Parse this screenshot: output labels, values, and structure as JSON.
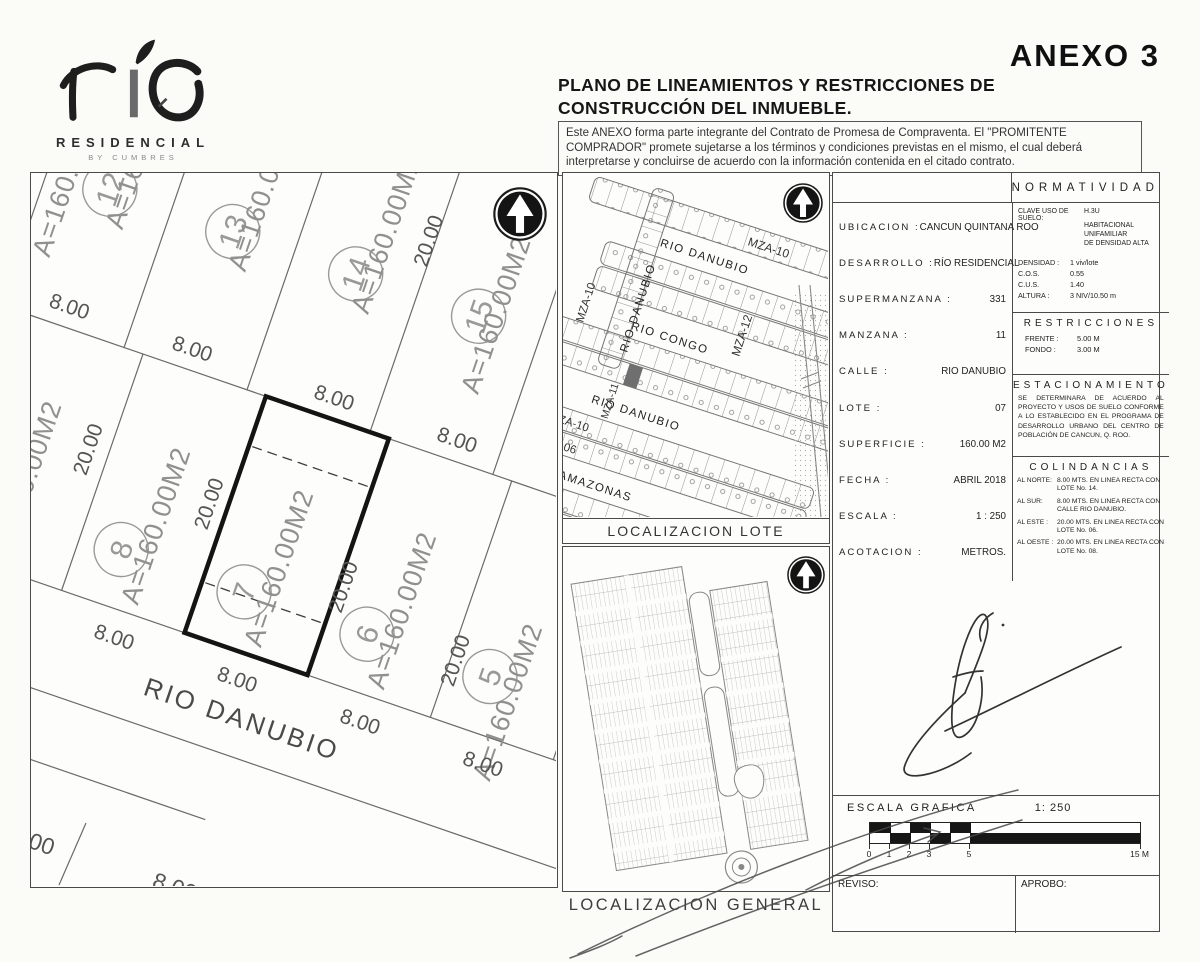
{
  "colors": {
    "ink": "#2f2f2f",
    "line": "#666666",
    "faded": "#909090",
    "highlight_lot_border": "#141414",
    "shaded_lot": "#6f6f6f",
    "paper": "#fbfbf8"
  },
  "logo": {
    "brand": "río",
    "line1": "RESIDENCIAL",
    "line2": "BY CUMBRES"
  },
  "header": {
    "annex": "ANEXO 3",
    "title_line1": "PLANO DE LINEAMIENTOS Y RESTRICCIONES DE",
    "title_line2": "CONSTRUCCIÓN DEL INMUEBLE.",
    "disclaimer": "Este ANEXO forma parte integrante del Contrato de Promesa de Compraventa. El \"PROMITENTE COMPRADOR\" promete sujetarse a los términos y condiciones previstas en el mismo, el cual deberá interpretarse y concluirse de acuerdo con la información contenida en el citado contrato."
  },
  "site_plan": {
    "street": "RIO DANUBIO",
    "area_label": "A=160.00M2",
    "front_dim": "8.00",
    "depth_dim": "20.00",
    "lots_top": [
      "12",
      "13",
      "14",
      "15"
    ],
    "lots_bottom": [
      "8",
      "7",
      "6",
      "5"
    ],
    "highlighted_lot": "7"
  },
  "map_lote": {
    "caption": "LOCALIZACION LOTE",
    "street_top": "RIO DANUBIO",
    "street_left": "RIO DANUBIO",
    "street_congo": "RIO CONGO",
    "street_lower": "RIO DANUBIO",
    "street_amazonas": "RIO AMAZONAS",
    "mza_top": "MZA-10",
    "mza_left": "MZA-10",
    "mza_12": "MZA-12",
    "mza_11": "MZA-11",
    "mza_10b": "MZA-10",
    "mza_06": "MZA-06"
  },
  "map_general": {
    "caption": "LOCALIZACION GENERAL"
  },
  "panel": {
    "normatividad_title": "NORMATIVIDAD",
    "fields": [
      {
        "label": "UBICACION :",
        "value": "CANCUN QUINTANA ROO"
      },
      {
        "label": "DESARROLLO :",
        "value": "RÍO RESIDENCIAL"
      },
      {
        "label": "SUPERMANZANA :",
        "value": "331"
      },
      {
        "label": "MANZANA :",
        "value": "11"
      },
      {
        "label": "CALLE :",
        "value": "RIO DANUBIO"
      },
      {
        "label": "LOTE :",
        "value": "07"
      },
      {
        "label": "SUPERFICIE :",
        "value": "160.00 M2"
      },
      {
        "label": "FECHA :",
        "value": "ABRIL 2018"
      },
      {
        "label": "ESCALA :",
        "value": "1 : 250"
      },
      {
        "label": "ACOTACION :",
        "value": "METROS."
      }
    ],
    "clave_label": "CLAVE USO DE SUELO:",
    "clave_value": "H.3U",
    "clave_desc1": "HABITACIONAL UNIFAMILIAR",
    "clave_desc2": "DE DENSIDAD ALTA",
    "norm_rows": [
      {
        "label": "DENSIDAD :",
        "value": "1 viv/lote"
      },
      {
        "label": "C.O.S.",
        "value": "0.55"
      },
      {
        "label": "C.U.S.",
        "value": "1.40"
      },
      {
        "label": "ALTURA :",
        "value": "3 NIV/10.50 m"
      }
    ],
    "restricciones_title": "RESTRICCIONES",
    "restr_rows": [
      {
        "label": "FRENTE :",
        "value": "5.00 M"
      },
      {
        "label": "FONDO :",
        "value": "3.00 M"
      }
    ],
    "estacionamiento_title": "ESTACIONAMIENTO",
    "estacionamiento_text": "SE DETERMINARA DE ACUERDO AL PROYECTO Y USOS DE SUELO CONFORME A LO ESTABLECIDO EN EL PROGRAMA DE DESARROLLO URBANO DEL CENTRO DE POBLACIÓN DE CANCUN, Q. ROO.",
    "colindancias_title": "COLINDANCIAS",
    "colindancias": [
      {
        "label": "AL NORTE:",
        "text": "8.00 MTS. EN LINEA RECTA CON LOTE No. 14."
      },
      {
        "label": "AL SUR:",
        "text": "8.00 MTS. EN LINEA RECTA CON CALLE RIO DANUBIO."
      },
      {
        "label": "AL ESTE :",
        "text": "20.00 MTS. EN LINEA RECTA CON LOTE No. 06."
      },
      {
        "label": "AL OESTE :",
        "text": "20.00 MTS. EN LINEA RECTA CON LOTE No. 08."
      }
    ]
  },
  "scale_bar": {
    "label": "ESCALA GRAFICA",
    "ratio": "1: 250",
    "ticks": [
      "0",
      "1",
      "2",
      "3",
      "5"
    ],
    "end": "15 M"
  },
  "sign": {
    "reviso": "REVISO:",
    "aprobo": "APROBO:"
  }
}
